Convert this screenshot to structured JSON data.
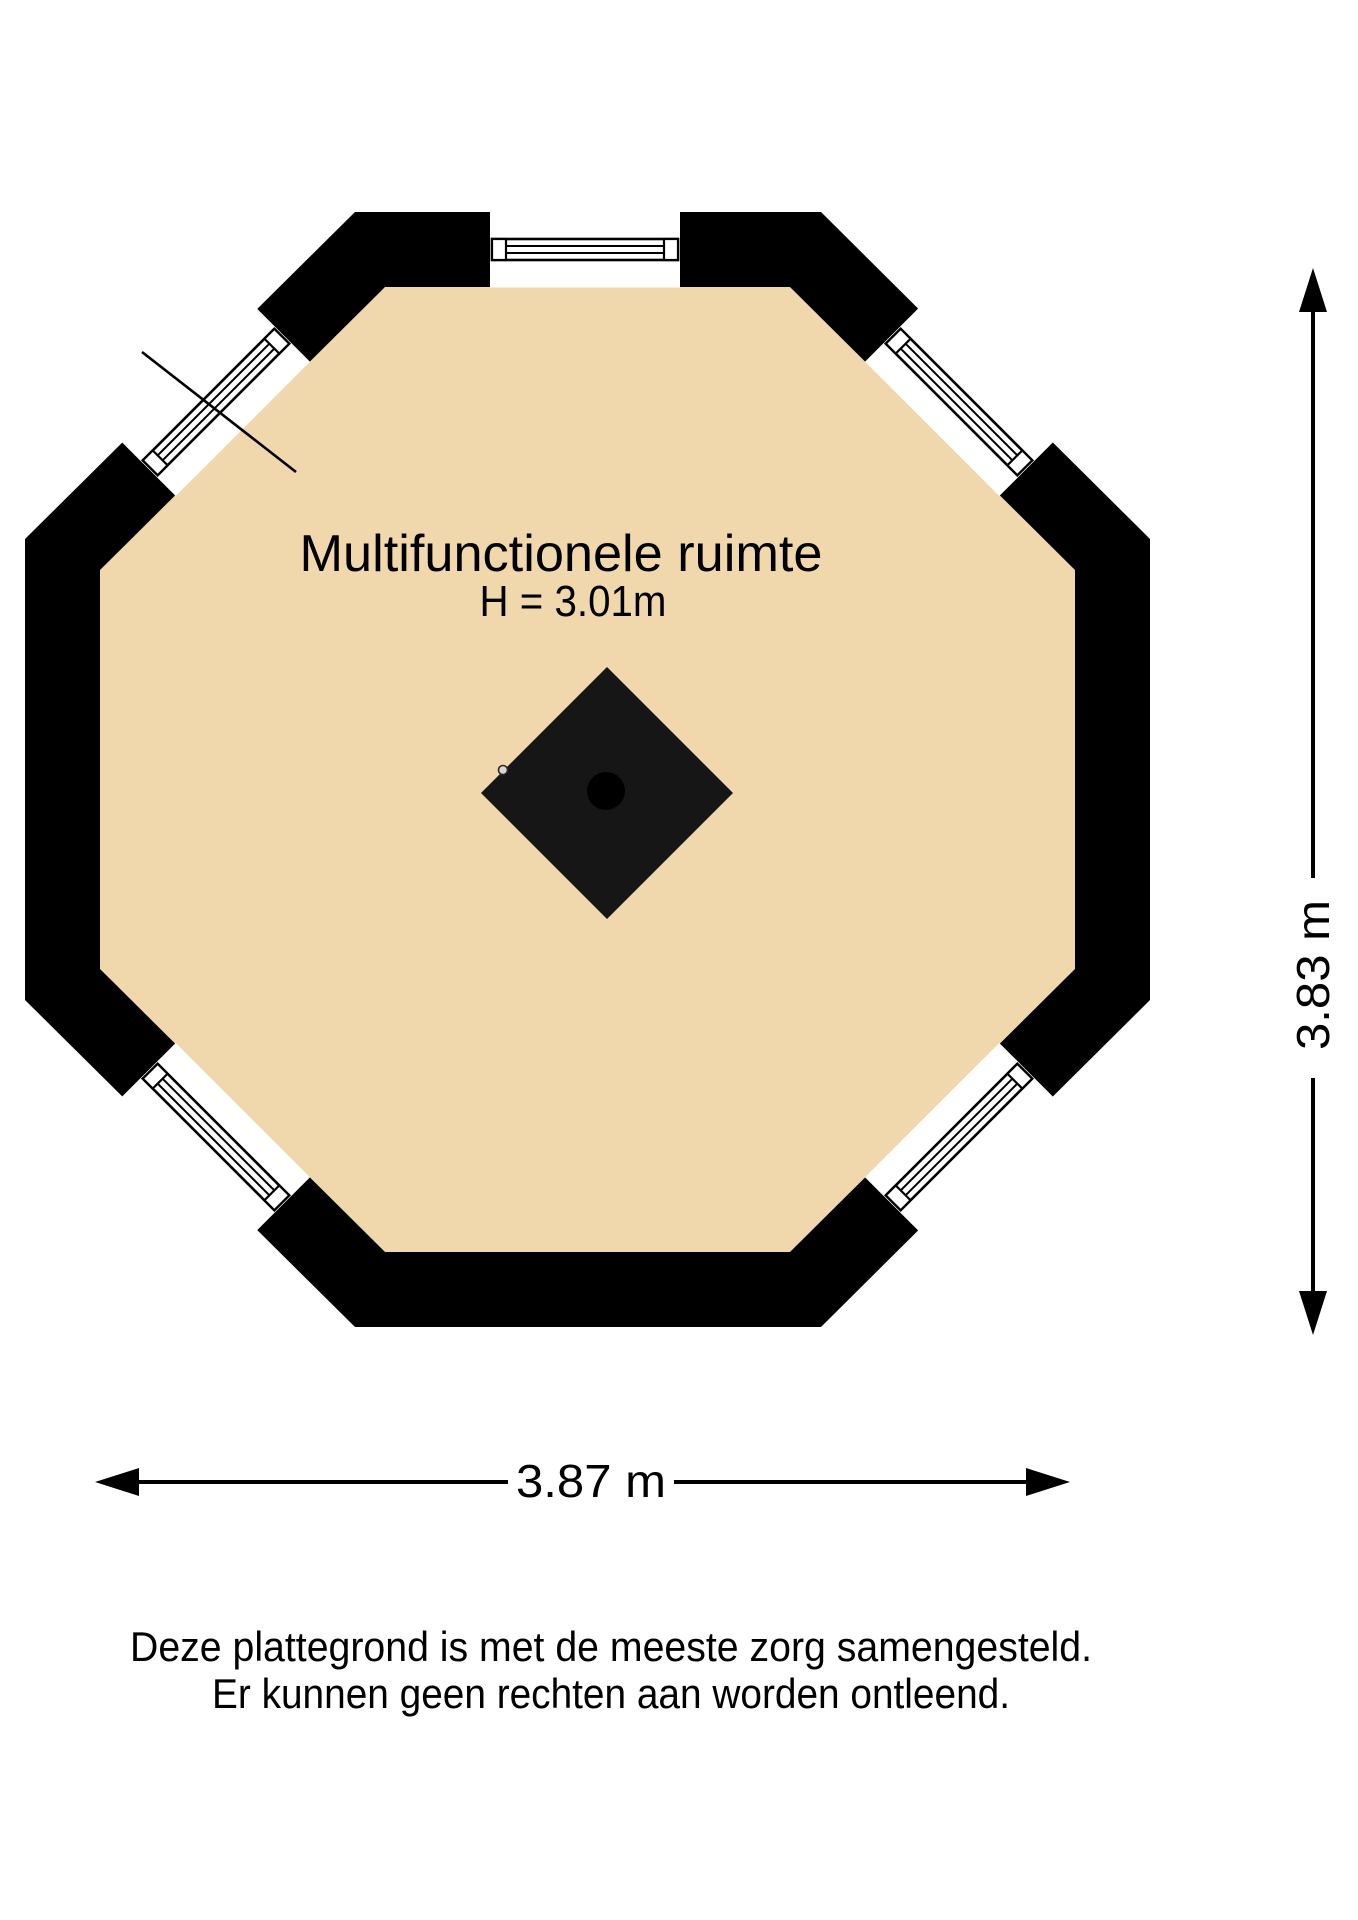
{
  "floorplan": {
    "room": {
      "label": "Multifunctionele ruimte",
      "height": "H = 3.01m"
    },
    "dim": {
      "width": "3.87 m",
      "height": "3.83 m"
    },
    "disclaimer": {
      "line1": "Deze plattegrond is met de meeste zorg samengesteld.",
      "line2": "Er kunnen geen rechten aan worden ontleend."
    },
    "colors": {
      "wall": "#000000",
      "floor": "#F0D8AC",
      "stove": "#161616",
      "stove_core": "#000000"
    },
    "icons": {
      "stove": "stove-diamond-icon",
      "stove_core": "stove-core-circle-icon",
      "marker": "knob-dot-icon",
      "arrows": "double-headed-arrow-icon"
    }
  }
}
